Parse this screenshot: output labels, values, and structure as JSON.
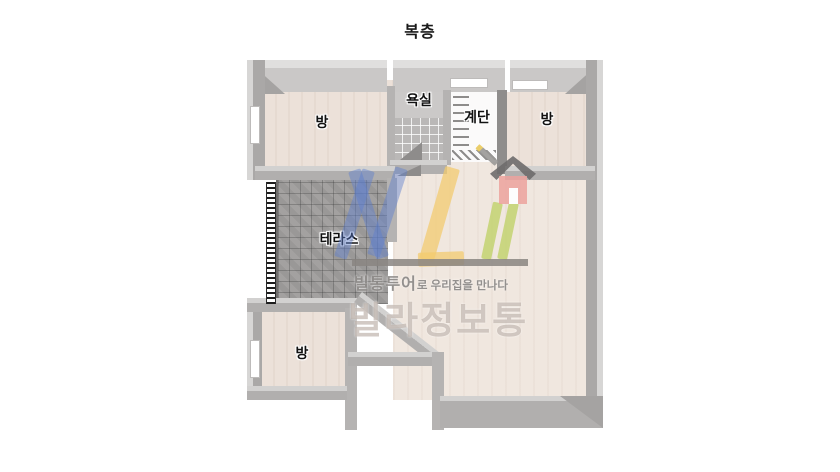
{
  "title": "복층",
  "rooms": [
    {
      "name": "room-top-left",
      "label": "방"
    },
    {
      "name": "bathroom",
      "label": "욕실"
    },
    {
      "name": "staircase",
      "label": "계단"
    },
    {
      "name": "room-top-right",
      "label": "방"
    },
    {
      "name": "terrace",
      "label": "테라스"
    },
    {
      "name": "room-bottom-left",
      "label": "방"
    }
  ],
  "watermark": {
    "tagline_brand": "빌통투어",
    "tagline_rest": "로 우리집을 만나다",
    "brand": "빌라정보통",
    "colors": {
      "blue": "#5d7fcf",
      "yellow": "#f2cb6c",
      "green": "#bfd166",
      "house_pink": "#eca29d",
      "text_gray": "#8f8c8a"
    }
  }
}
